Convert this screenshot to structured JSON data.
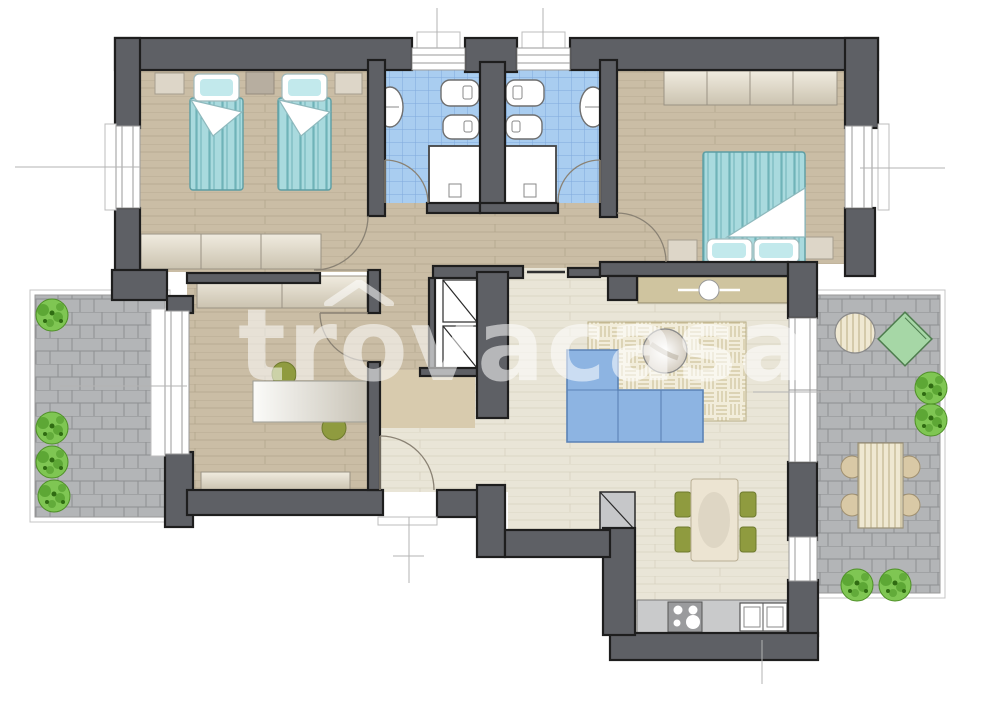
{
  "watermark": {
    "text": "trovacasa"
  },
  "palette": {
    "wall": "#5e6065",
    "wall_outline": "#1e1e1e",
    "floor_wood": "#cabda5",
    "floor_wood_line": "#b3a68c",
    "floor_light": "#e9e5d7",
    "floor_light_line": "#d7d2bf",
    "bath_tile": "#a9cdf0",
    "bath_tile_line": "#7fa9dd",
    "paving": "#b3b5b7",
    "paving_line": "#8e9092",
    "bed_teal": "#a9dade",
    "bed_stripe": "#6fb3b8",
    "sofa": "#8db4e2",
    "sofa_outline": "#5b82b5",
    "rug": "#f2eddb",
    "rug_weave": "#cfc49e",
    "chair_olive": "#8f9b3f",
    "sideboard": "#cfc49f",
    "counter": "#c9cacb",
    "appliance": "#9a9b9d",
    "bush": "#7fc653",
    "bush_shade": "#4f9a29",
    "lounge": "#a6d7a6",
    "cabinet": "#e2dbcb",
    "mat": "#d8cbae",
    "watermark": "rgba(255,255,255,0.55)"
  },
  "plan": {
    "type": "apartment-floor-plan",
    "rooms": [
      "twin-bedroom",
      "bathroom-1",
      "bathroom-2",
      "double-bedroom",
      "study-bedroom",
      "hallway",
      "living-room",
      "kitchen-dining",
      "terrace-left",
      "terrace-right"
    ],
    "furniture": [
      "twin-bed",
      "twin-bed",
      "double-bed",
      "nightstand",
      "wardrobe",
      "dresser",
      "desk",
      "office-chair",
      "sofa",
      "rug",
      "coffee-table",
      "sideboard",
      "dining-table",
      "dining-chair",
      "stove",
      "kitchen-sink",
      "washbasin",
      "toilet",
      "bidet",
      "shower",
      "outdoor-table",
      "outdoor-chair",
      "round-table",
      "lounge-pad",
      "bush"
    ]
  }
}
